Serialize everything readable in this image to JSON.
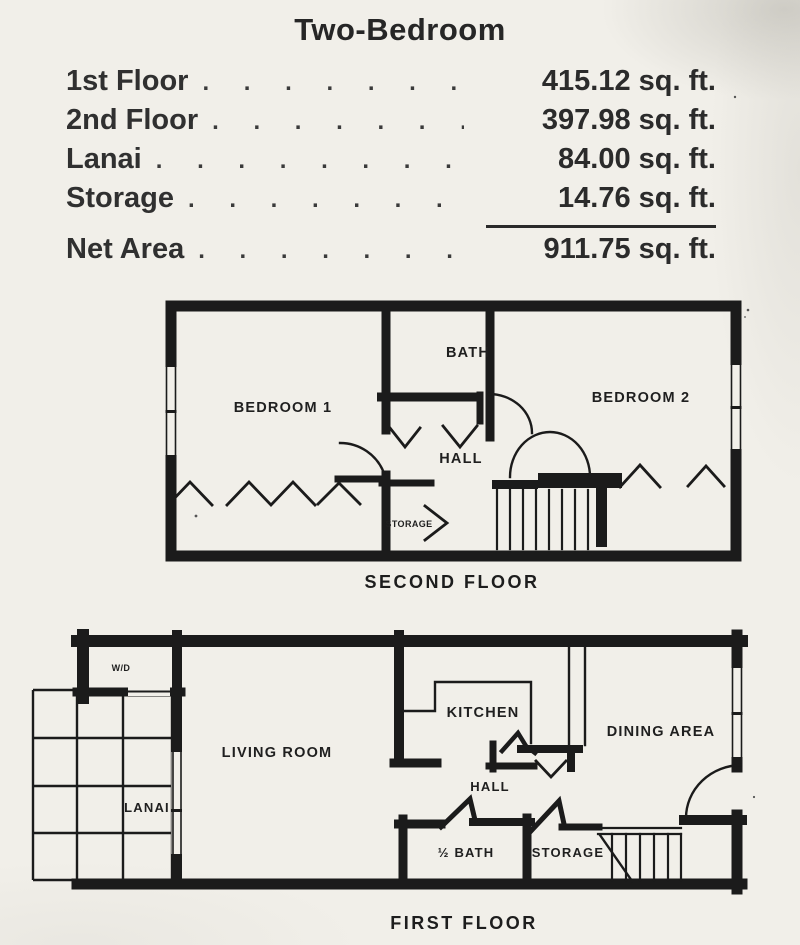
{
  "title": "Two-Bedroom",
  "area_table": {
    "rows": [
      {
        "label": "1st Floor",
        "dots": ". . . . . . . . . . .",
        "value": "415.12 sq. ft."
      },
      {
        "label": "2nd Floor",
        "dots": ". . . . . . . . . .",
        "value": "397.98 sq. ft."
      },
      {
        "label": "Lanai",
        "dots": ". . . . . . . . . . . . . .",
        "value": "84.00 sq. ft."
      },
      {
        "label": "Storage",
        "dots": ". . . . . . . . . . . . .",
        "value": "14.76 sq. ft."
      }
    ],
    "total": {
      "label": "Net Area",
      "dots": ". . . . . . . . . . . .",
      "value": "911.75 sq. ft."
    }
  },
  "second_floor": {
    "caption": "SECOND FLOOR",
    "rooms": {
      "bedroom1": "BEDROOM 1",
      "bath": "BATH",
      "bedroom2": "BEDROOM 2",
      "hall": "HALL",
      "storage": "STORAGE"
    }
  },
  "first_floor": {
    "caption": "FIRST FLOOR",
    "rooms": {
      "wd": "W/D",
      "living": "LIVING ROOM",
      "kitchen": "KITCHEN",
      "dining": "DINING AREA",
      "hall": "HALL",
      "lanai": "LANAI",
      "half_bath": "½ BATH",
      "storage": "STORAGE"
    }
  }
}
